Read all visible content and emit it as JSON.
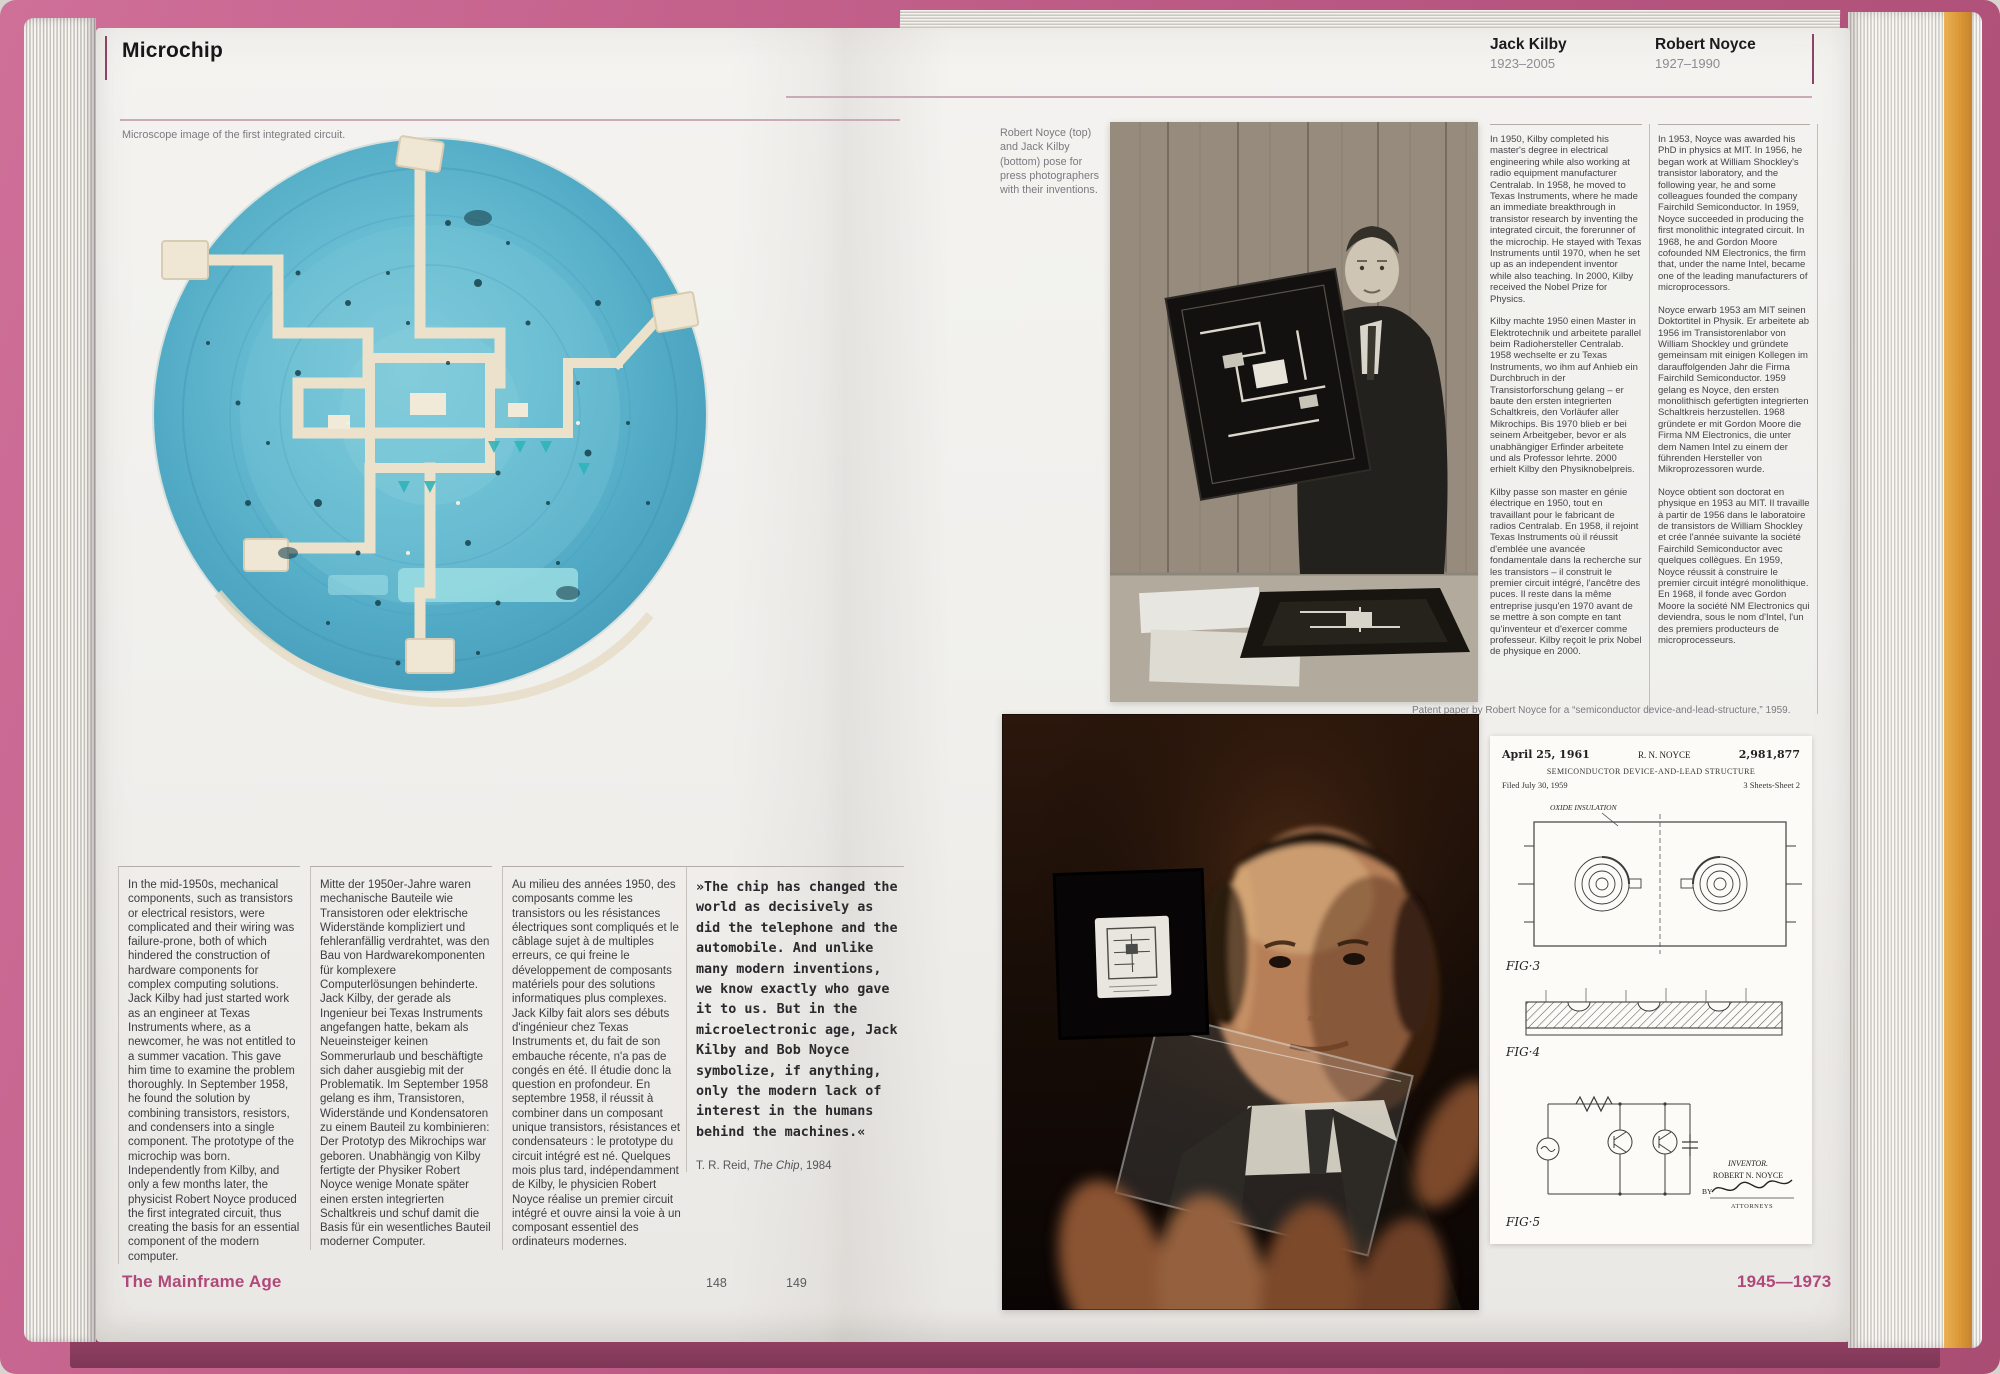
{
  "colors": {
    "cover_pink": "#c4628c",
    "accent_pink": "#b0497a",
    "page_background": "#f1f0ed",
    "chip_blue": "#5fb4cc",
    "edge_orange": "#d9912d",
    "patent_paper": "#fcfbf7"
  },
  "left_page": {
    "header": "Microchip",
    "image_caption": "Microscope image of the first integrated circuit.",
    "intro": {
      "english": "In the mid-1950s, mechanical components, such as transistors or electrical resistors, were complicated and their wiring was failure-prone, both of which hindered the construction of hardware components for complex computing solutions. Jack Kilby had just started work as an engineer at Texas Instruments where, as a newcomer, he was not entitled to a summer vacation. This gave him time to examine the problem thoroughly. In September 1958, he found the solution by combining transistors, resistors, and condensers into a single component. The prototype of the microchip was born. Independently from Kilby, and only a few months later, the physicist Robert Noyce produced the first integrated circuit, thus creating the basis for an essential component of the modern computer.",
      "german": "Mitte der 1950er-Jahre waren mechanische Bauteile wie Transistoren oder elektrische Widerstände kompliziert und fehleranfällig verdrahtet, was den Bau von Hardwarekomponenten für komplexere Computerlösungen behinderte. Jack Kilby, der gerade als Ingenieur bei Texas Instruments angefangen hatte, bekam als Neueinsteiger keinen Sommerurlaub und beschäftigte sich daher ausgiebig mit der Problematik. Im September 1958 gelang es ihm, Transistoren, Widerstände und Kondensatoren zu einem Bauteil zu kombinieren: Der Prototyp des Mikrochips war geboren. Unabhängig von Kilby fertigte der Physiker Robert Noyce wenige Monate später einen ersten integrierten Schaltkreis und schuf damit die Basis für ein wesentliches Bauteil moderner Computer.",
      "french": "Au milieu des années 1950, des composants comme les transistors ou les résistances électriques sont compliqués et le câblage sujet à de multiples erreurs, ce qui freine le développement de composants matériels pour des solutions informatiques plus complexes. Jack Kilby fait alors ses débuts d'ingénieur chez Texas Instruments et, du fait de son embauche récente, n'a pas de congés en été. Il étudie donc la question en profondeur. En septembre 1958, il réussit à combiner dans un composant unique transistors, résistances et condensateurs : le prototype du circuit intégré est né. Quelques mois plus tard, indépendamment de Kilby, le physicien Robert Noyce réalise un premier circuit intégré et ouvre ainsi la voie à un composant essentiel des ordinateurs modernes."
    },
    "quote": {
      "text": "»The chip has changed the world as decisively as did the telephone and the automobile. And unlike many modern inventions, we know exactly who gave it to us. But in the microelectronic age, Jack Kilby and Bob Noyce symbolize, if anything, only the modern lack of interest in the humans behind the machines.«",
      "attr_pre": "T. R. Reid, ",
      "attr_title": "The Chip",
      "attr_post": ", 1984"
    },
    "footer_label": "The Mainframe Age",
    "page_number": "148"
  },
  "right_page": {
    "header": {
      "kilby_name": "Jack Kilby",
      "kilby_years": "1923–2005",
      "noyce_name": "Robert Noyce",
      "noyce_years": "1927–1990"
    },
    "photo_caption": "Robert Noyce (top) and Jack Kilby (bottom) pose for press photographers with their inventions.",
    "kilby_bio": {
      "english": "In 1950, Kilby completed his master's degree in electrical engineering while also working at radio equipment manufacturer Centralab. In 1958, he moved to Texas Instruments, where he made an immediate breakthrough in transistor research by inventing the integrated circuit, the forerunner of the microchip. He stayed with Texas Instruments until 1970, when he set up as an independent inventor while also teaching. In 2000, Kilby received the Nobel Prize for Physics.",
      "german": "Kilby machte 1950 einen Master in Elektrotechnik und arbeitete parallel beim Radiohersteller Centralab. 1958 wechselte er zu Texas Instruments, wo ihm auf Anhieb ein Durchbruch in der Transistorforschung gelang – er baute den ersten integrierten Schaltkreis, den Vorläufer aller Mikrochips. Bis 1970 blieb er bei seinem Arbeitgeber, bevor er als unabhängiger Erfinder arbeitete und als Professor lehrte. 2000 erhielt Kilby den Physiknobelpreis.",
      "french": "Kilby passe son master en génie électrique en 1950, tout en travaillant pour le fabricant de radios Centralab. En 1958, il rejoint Texas Instruments où il réussit d'emblée une avancée fondamentale dans la recherche sur les transistors – il construit le premier circuit intégré, l'ancêtre des puces. Il reste dans la même entreprise jusqu'en 1970 avant de se mettre à son compte en tant qu'inventeur et d'exercer comme professeur. Kilby reçoit le prix Nobel de physique en 2000."
    },
    "noyce_bio": {
      "english": "In 1953, Noyce was awarded his PhD in physics at MIT. In 1956, he began work at William Shockley's transistor laboratory, and the following year, he and some colleagues founded the company Fairchild Semiconductor. In 1959, Noyce succeeded in producing the first monolithic integrated circuit. In 1968, he and Gordon Moore cofounded NM Electronics, the firm that, under the name Intel, became one of the leading manufacturers of microprocessors.",
      "german": "Noyce erwarb 1953 am MIT seinen Doktortitel in Physik. Er arbeitete ab 1956 im Transistorenlabor von William Shockley und gründete gemeinsam mit einigen Kollegen im darauffolgenden Jahr die Firma Fairchild Semiconductor. 1959 gelang es Noyce, den ersten monolithisch gefertigten integrierten Schaltkreis herzustellen. 1968 gründete er mit Gordon Moore die Firma NM Electronics, die unter dem Namen Intel zu einem der führenden Hersteller von Mikroprozessoren wurde.",
      "french": "Noyce obtient son doctorat en physique en 1953 au MIT. Il travaille à partir de 1956 dans le laboratoire de transistors de William Shockley et crée l'année suivante la société Fairchild Semiconductor avec quelques collègues. En 1959, Noyce réussit à construire le premier circuit intégré monolithique. En 1968, il fonde avec Gordon Moore la société NM Electronics qui deviendra, sous le nom d'Intel, l'un des premiers producteurs de microprocesseurs."
    },
    "patent_caption": "Patent paper by Robert Noyce for a “semiconductor device-and-lead-structure,” 1959.",
    "patent": {
      "date": "April 25, 1961",
      "inventor_header": "R. N. NOYCE",
      "number": "2,981,877",
      "title": "SEMICONDUCTOR DEVICE-AND-LEAD STRUCTURE",
      "filed": "Filed July 30, 1959",
      "sheets": "3 Sheets-Sheet 2",
      "oxide_label": "OXIDE INSULATION",
      "fig3_label": "FIG·3",
      "fig4_label": "FIG·4",
      "fig5_label": "FIG·5",
      "inventor_label": "INVENTOR.",
      "inventor_name": "ROBERT N. NOYCE",
      "by_label": "BY",
      "attorneys_label": "ATTORNEYS"
    },
    "page_number": "149",
    "footer_label": "1945—1973"
  }
}
